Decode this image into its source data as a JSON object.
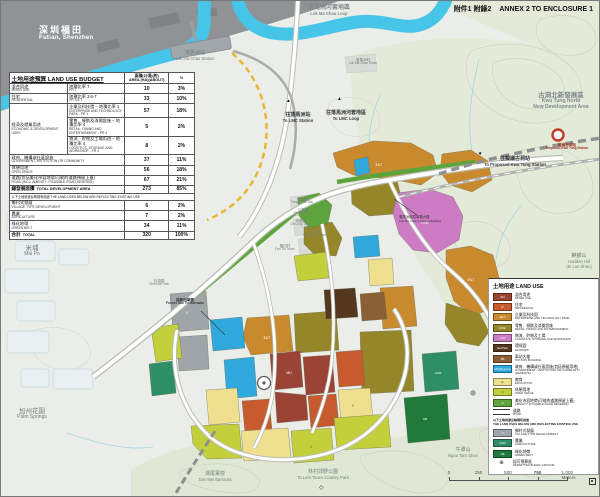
{
  "annex_title": {
    "zh": "附件1 附錄2",
    "en": "ANNEX 2 TO ENCLOSURE 1"
  },
  "icons": {
    "arrow_up": "▲",
    "diamond": "◇",
    "burial": "⊕"
  },
  "map_labels": {
    "futian": {
      "zh": "深圳福田",
      "en": "Futian, Shenzhen"
    },
    "lmc_loop": {
      "zh": "落馬洲河套地區",
      "en": "Lok Ma Chau Loop"
    },
    "lmc_station": {
      "zh": "落馬洲站",
      "en": "Lok Ma Chau Station"
    },
    "lmc_tsuen": {
      "zh": "落馬洲村",
      "en": "Lok Ma Chau Tsuen"
    },
    "to_lmc_station": {
      "zh": "往落馬洲站",
      "en": "To LMC Station"
    },
    "to_lmc_loop": {
      "zh": "往落馬洲河套地區",
      "en": "To LMC Loop"
    },
    "kwu_tung_north": {
      "zh": "古洞北新發展區",
      "en": "Kwu Tung North",
      "en2": "New Development Area"
    },
    "proposed_kt_station": {
      "zh": "擬議古洞站",
      "en": "Proposed Kwu Tung Station"
    },
    "to_proposed_kt": {
      "zh": "往擬議古洞站",
      "en": "To Proposed Kwu Tung Station"
    },
    "haddon_hill": {
      "zh": "麒麟山",
      "en": "Haddon Hill",
      "en2": "(Ki Lun Shan)"
    },
    "mai_po": {
      "zh": "米埔",
      "en": "Mai Po"
    },
    "palm_springs": {
      "zh": "加州花園",
      "en": "Palm Springs"
    },
    "ngau_tam_shan": {
      "zh": "牛潭山",
      "en": "Ngau Tam Shan"
    },
    "tam_mei_barracks": {
      "zh": "潭尾軍營",
      "en": "Tam Mei Barracks"
    },
    "lam_tsuen": {
      "zh": "林村郊野公園",
      "en": "To Lam Tsuen Country Park"
    },
    "shek_wu_wai": {
      "zh": "石湖圍",
      "en": "Shek Wu Wai"
    },
    "former_barracks": {
      "zh": "前新田軍營",
      "en": "Former San Tin Barracks"
    },
    "crossing_building": {
      "zh": "落馬洲過境事務大樓",
      "en": "Lok Ma Chau Crossing Building"
    },
    "tung_chan_wai": {
      "zh": "東鎮圍",
      "en": "Tung Chan Wai"
    },
    "yan_sau_wai": {
      "zh": "仁壽圍",
      "en": "Yan Sau Wai"
    },
    "on_lung_tsuen": {
      "zh": "安龍村",
      "en": "On Lung Tsuen"
    },
    "wing_ping_tsuen": {
      "zh": "永平村",
      "en": "Wing Ping Tsuen"
    },
    "fan_tin_tsuen": {
      "zh": "蕃田村",
      "en": "Fan Tin Tsuen"
    }
  },
  "budget": {
    "title": "土地用途預算 LAND USE BUDGET",
    "col_area_zh": "面積(公頃)(約)",
    "col_area_en": "AREA (HA)(ABOUT)",
    "col_pct": "%",
    "rows": [
      {
        "zh": "混合用途",
        "en": "MIXED USE",
        "sub_zh": "地積比率 7",
        "sub_en": "PR 7",
        "area": "10",
        "pct": "3%"
      },
      {
        "zh": "住宅",
        "en": "RESIDENTIAL",
        "sub_zh": "地積比率 3.6-7",
        "sub_en": "PR 3.6-7",
        "area": "33",
        "pct": "10%"
      },
      {
        "zh": "經濟及就業用途",
        "en": "ECONOMIC & DEVELOPMENT USES",
        "sub_zh": "企業及科技園 – 地積比率 1",
        "sub_en": "ENTERPRISE AND TECHNOLOGY PARK - PR 1",
        "area": "57",
        "pct": "18%"
      },
      {
        "sub_zh": "零售、餐飲及消閒設施 – 地積比率 4",
        "sub_en": "RETAIL, DINING AND ENTERTAINMENT - PR 4",
        "area": "5",
        "pct": "2%"
      },
      {
        "sub_zh": "物流、貯物及工場用途 – 地積比率 4",
        "sub_en": "LOGISTICS, STORAGE AND WORKSHOP - PR 4",
        "area": "8",
        "pct": "2%"
      },
      {
        "zh": "政府、機構或社區設施",
        "en": "GOVERNMENT, INSTITUTION OR COMMUNITY",
        "area": "37",
        "pct": "11%"
      },
      {
        "zh": "休憩用地",
        "en": "OPEN SPACE",
        "area": "56",
        "pct": "18%"
      },
      {
        "zh": "道路(包括美化市容地帶/可能的道路預留上蓋)",
        "en": "ROAD (INCL. AMENITY / FEASIBLE ROAD RESERVE)",
        "area": "67",
        "pct": "21%"
      }
    ],
    "subtotal": {
      "zh": "總發展面積",
      "en": "TOTAL DEVELOPMENT AREA",
      "area": "273",
      "pct": "85%"
    },
    "note": {
      "zh": "以下土地用途反映現有用途",
      "en": "THE LAND USES BELOW ARE REFLECTING EXISTING USE"
    },
    "existing_rows": [
      {
        "zh": "鄉村式發展",
        "en": "VILLAGE TYPE DEVELOPMENT",
        "area": "6",
        "pct": "2%"
      },
      {
        "zh": "農業",
        "en": "AGRICULTURE",
        "area": "7",
        "pct": "2%"
      },
      {
        "zh": "綠化地帶",
        "en": "GREEN BELT",
        "area": "34",
        "pct": "11%"
      }
    ],
    "total": {
      "zh": "合計",
      "en": "TOTAL",
      "area": "320",
      "pct": "100%"
    }
  },
  "legend": {
    "title": "土地用途 LAND USE",
    "items": [
      {
        "code": "MU",
        "zh": "混合用途",
        "en": "MIXED USE",
        "color": "#9B4436"
      },
      {
        "code": "R",
        "zh": "住宅",
        "en": "RESIDENTIAL",
        "color": "#C75B2E"
      },
      {
        "code": "E&T",
        "zh": "企業及科技園",
        "en": "ENTERPRISE AND TECHNOLOGY PARK",
        "color": "#C98A2E"
      },
      {
        "code": "RDE",
        "zh": "零售、餐飲及消閒設施",
        "en": "RETAIL, DINING AND ENTERTAINMENT",
        "color": "#96862A"
      },
      {
        "code": "LSW",
        "zh": "物流、貯物及工場",
        "en": "LOGISTICS, STORAGE AND WORKSHOP",
        "color": "#CC7BC4"
      },
      {
        "code": "EcoPark",
        "zh": "環保園",
        "en": "ECOPARK",
        "color": "#54381E"
      },
      {
        "code": "SB",
        "zh": "車站大樓",
        "en": "STATION BUILDING",
        "color": "#8A6134"
      },
      {
        "code": "G/IC(Reserve)",
        "zh": "政府、機構或社區設施(包括預留用地)",
        "en": "GOVERNMENT / INSTITUTION OR COMMUNITY (RESERVE)",
        "color": "#2FA8DC"
      },
      {
        "code": "E",
        "zh": "教育",
        "en": "EDUCATION",
        "color": "#EFE08F"
      },
      {
        "code": "O",
        "zh": "休憩用地",
        "en": "OPEN SPACE",
        "color": "#C3CF3B"
      },
      {
        "code": "A",
        "zh": "美化市容地帶(可能的道路預留上蓋)",
        "en": "AMENITY (POSSIBLE ROAD RESERVE)",
        "color": "#5EA43C"
      }
    ],
    "road": {
      "zh": "道路",
      "en": "ROAD"
    },
    "note": {
      "zh": "以下土地用途反映現有用途",
      "en": "THE LAND USES BELOW ARE REFLECTING EXISTING USE"
    },
    "existing_items": [
      {
        "code": "V",
        "zh": "鄉村式發展",
        "en": "VILLAGE TYPE DEVELOPMENT",
        "color": "#9FA5A8"
      },
      {
        "code": "AGR",
        "zh": "農業",
        "en": "AGRICULTURE",
        "color": "#2E8F66"
      },
      {
        "code": "GB",
        "zh": "綠化地帶",
        "en": "GREEN BELT",
        "color": "#20793B"
      }
    ],
    "burial": {
      "zh": "認可殯葬區",
      "en": "PERMITTED BURIAL GROUND"
    }
  },
  "scalebar": {
    "t0": "0",
    "t1": "250",
    "t2": "500",
    "t3": "750",
    "end": "1,000 Meters"
  }
}
